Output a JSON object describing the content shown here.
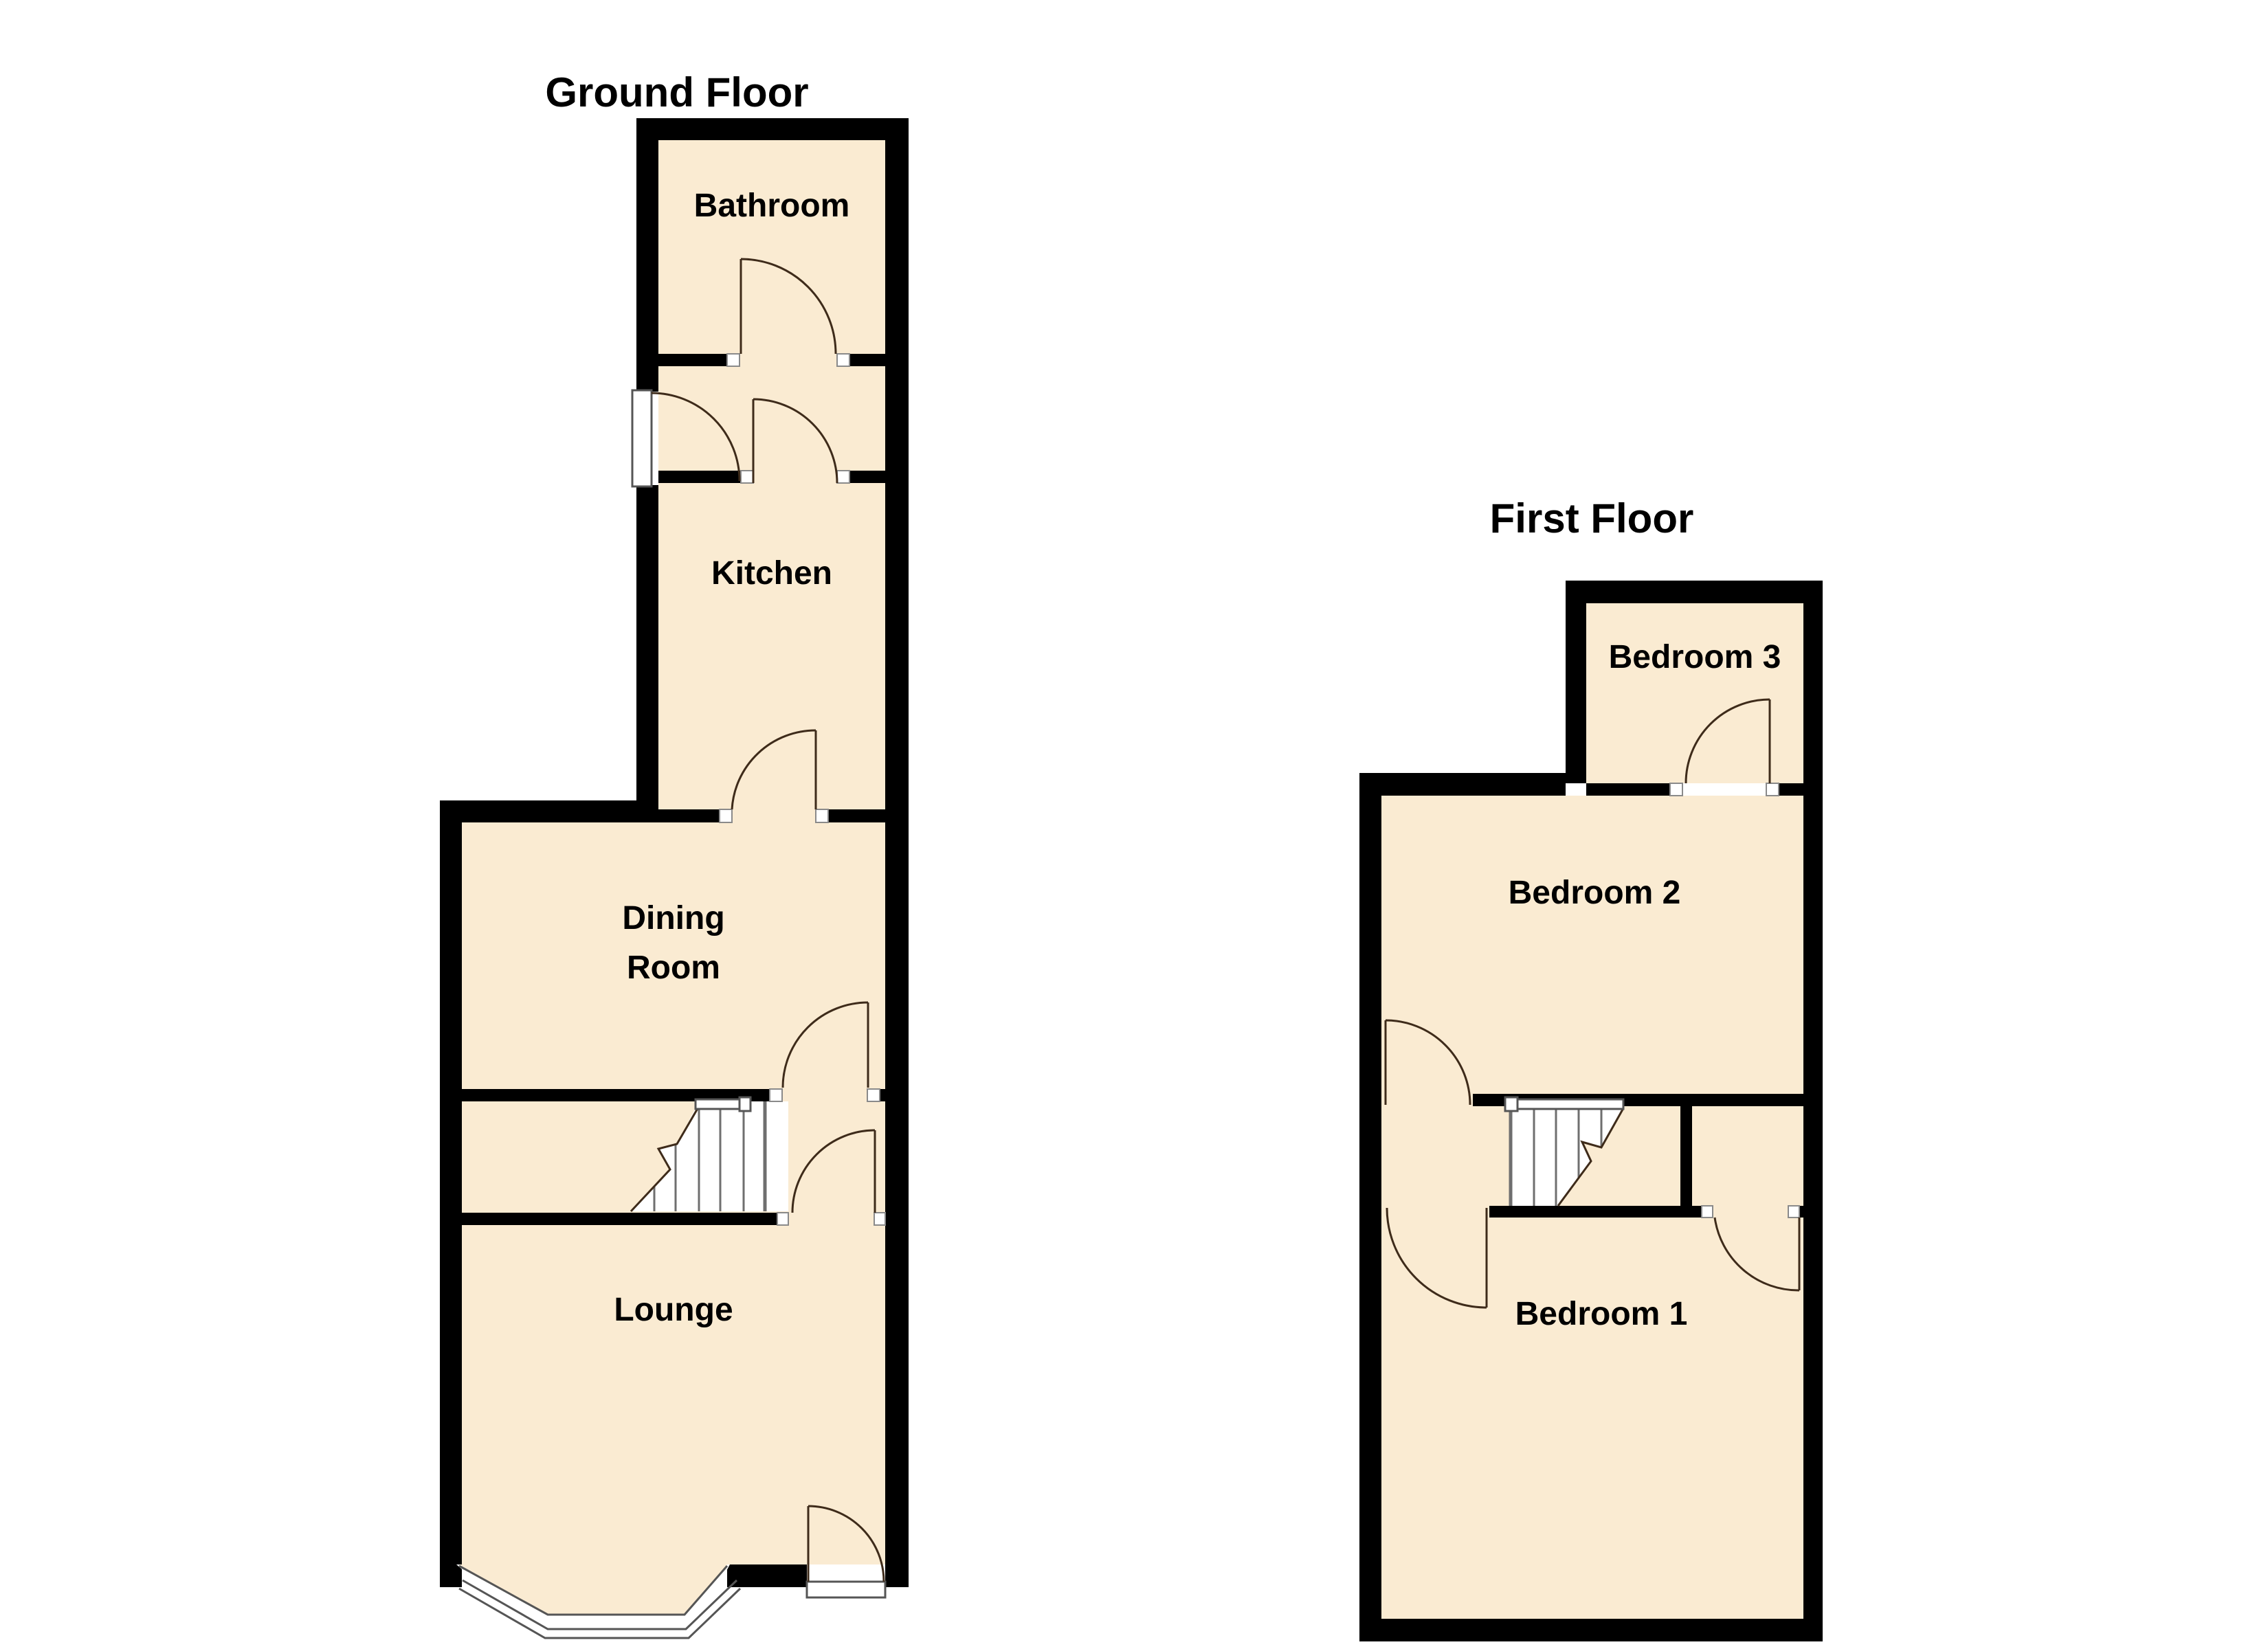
{
  "document_title": "Floor Plan",
  "floors": {
    "ground": {
      "title": "Ground Floor",
      "rooms": {
        "bathroom": "Bathroom",
        "kitchen": "Kitchen",
        "dining_line1": "Dining",
        "dining_line2": "Room",
        "lounge": "Lounge"
      }
    },
    "first": {
      "title": "First Floor",
      "rooms": {
        "bedroom3": "Bedroom 3",
        "bedroom2": "Bedroom 2",
        "bedroom1": "Bedroom 1"
      }
    }
  },
  "colors": {
    "floor": "#FAEBD2",
    "wall": "#000000",
    "door_line": "#3E2B1A",
    "stair_line": "#6F6F6F",
    "background": "#FFFFFF"
  }
}
